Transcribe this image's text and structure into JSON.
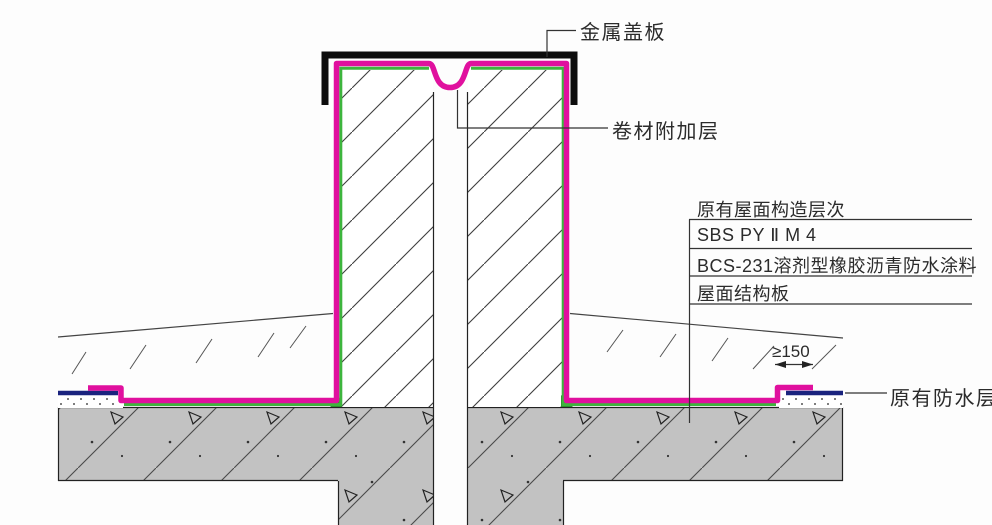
{
  "labels": {
    "metal_cover": "金属盖板",
    "membrane_strip": "卷材附加层",
    "existing_waterproof": "原有防水层",
    "dimension": "≥150"
  },
  "layer_table": {
    "title": "原有屋面构造层次",
    "rows": [
      "SBS PY Ⅱ M 4",
      "BCS-231溶剂型橡胶沥青防水涂料",
      "屋面结构板"
    ]
  },
  "colors": {
    "membrane": "#E0109E",
    "protection": "#3DB53D",
    "existing_membrane": "#1A237E",
    "concrete": "#C2C2C2",
    "cover_plate": "#0D0D0D"
  }
}
